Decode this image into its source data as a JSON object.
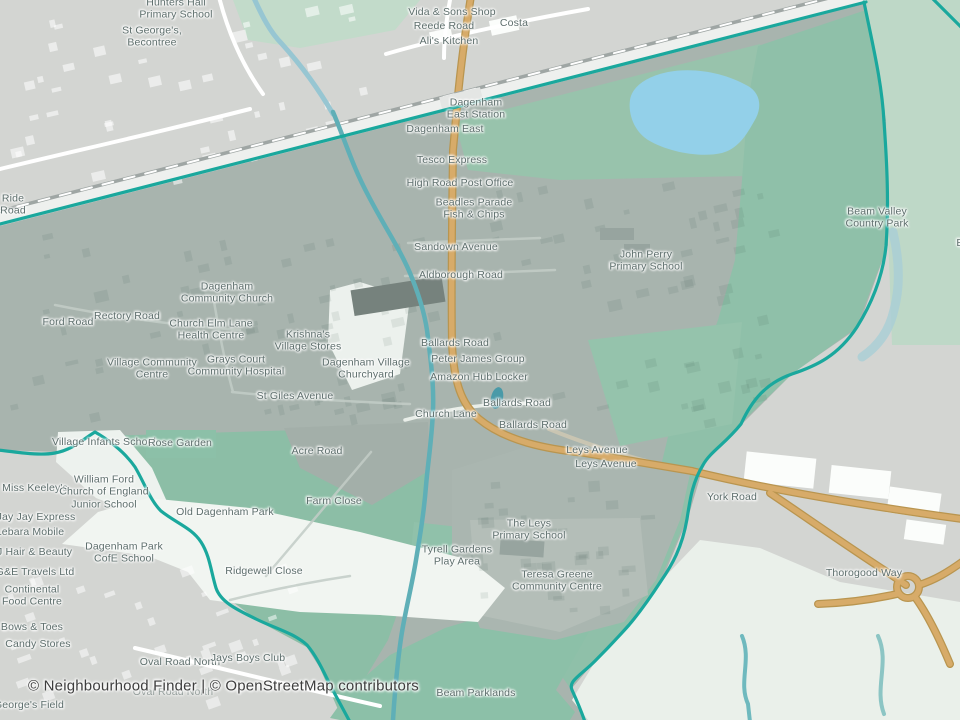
{
  "map": {
    "attribution": "© Neighbourhood Finder | © OpenStreetMap contributors",
    "colors": {
      "base_gray": "#d3d5d2",
      "inside_urban": "#a8b4ae",
      "inside_park_green": "#8fc0a8",
      "outside_park_green": "#bed8c7",
      "fields_pale": "#eaf0ea",
      "lake_blue": "#93d0e9",
      "river_teal": "#5fafb7",
      "boundary_teal": "#1aa89d",
      "road_orange": "#d2a763",
      "road_white": "#ffffff",
      "label_gray": "#5d6e6c"
    },
    "labels": [
      {
        "t": "Hunters Hall\nPrimary School",
        "x": 176,
        "y": 9
      },
      {
        "t": "St George's,\nBecontree",
        "x": 152,
        "y": 37
      },
      {
        "t": "Vida & Sons Shop",
        "x": 452,
        "y": 12
      },
      {
        "t": "Reede Road",
        "x": 444,
        "y": 26
      },
      {
        "t": "Ali's Kitchen",
        "x": 449,
        "y": 41
      },
      {
        "t": "Costa",
        "x": 514,
        "y": 23
      },
      {
        "t": "Ride\nRoad",
        "x": 13,
        "y": 205
      },
      {
        "t": "Dagenham\nEast Station",
        "x": 476,
        "y": 109
      },
      {
        "t": "Dagenham East",
        "x": 445,
        "y": 129
      },
      {
        "t": "Tesco Express",
        "x": 452,
        "y": 160
      },
      {
        "t": "High Road Post Office",
        "x": 460,
        "y": 183
      },
      {
        "t": "Beadles Parade\nFish & Chips",
        "x": 474,
        "y": 209
      },
      {
        "t": "Sandown Avenue",
        "x": 456,
        "y": 247
      },
      {
        "t": "Aldborough Road",
        "x": 461,
        "y": 275
      },
      {
        "t": "John Perry\nPrimary School",
        "x": 646,
        "y": 261
      },
      {
        "t": "Beam Valley\nCountry Park",
        "x": 877,
        "y": 218
      },
      {
        "t": "Bretons",
        "x": 975,
        "y": 243
      },
      {
        "t": "Ford Road",
        "x": 68,
        "y": 322
      },
      {
        "t": "Rectory Road",
        "x": 127,
        "y": 316
      },
      {
        "t": "Dagenham\nCommunity Church",
        "x": 227,
        "y": 293
      },
      {
        "t": "Church Elm Lane\nHealth Centre",
        "x": 211,
        "y": 330
      },
      {
        "t": "Krishna's\nVillage Stores",
        "x": 308,
        "y": 341
      },
      {
        "t": "Village Community\nCentre",
        "x": 152,
        "y": 369
      },
      {
        "t": "Grays Court\nCommunity Hospital",
        "x": 236,
        "y": 366
      },
      {
        "t": "Dagenham Village\nChurchyard",
        "x": 366,
        "y": 369
      },
      {
        "t": "Ballards Road",
        "x": 455,
        "y": 343
      },
      {
        "t": "Peter James Group",
        "x": 478,
        "y": 359
      },
      {
        "t": "Amazon Hub Locker",
        "x": 479,
        "y": 377
      },
      {
        "t": "St Giles Avenue",
        "x": 295,
        "y": 396
      },
      {
        "t": "Church Lane",
        "x": 446,
        "y": 414
      },
      {
        "t": "Ballards Road",
        "x": 517,
        "y": 403
      },
      {
        "t": "Ballards Road",
        "x": 533,
        "y": 425
      },
      {
        "t": "Leys Avenue",
        "x": 597,
        "y": 450
      },
      {
        "t": "Leys Avenue",
        "x": 606,
        "y": 464
      },
      {
        "t": "York Road",
        "x": 732,
        "y": 497
      },
      {
        "t": "Village Infants School",
        "x": 104,
        "y": 442
      },
      {
        "t": "Rose Garden",
        "x": 180,
        "y": 443
      },
      {
        "t": "Miss Keeley's",
        "x": 35,
        "y": 488
      },
      {
        "t": "William Ford\nChurch of England\nJunior School",
        "x": 104,
        "y": 492
      },
      {
        "t": "Jay Jay Express",
        "x": 36,
        "y": 517
      },
      {
        "t": "Lebara Mobile",
        "x": 30,
        "y": 532
      },
      {
        "t": "&J Hair & Beauty",
        "x": 31,
        "y": 552
      },
      {
        "t": "G&E Travels Ltd",
        "x": 35,
        "y": 572
      },
      {
        "t": "Continental\nFood Centre",
        "x": 32,
        "y": 596
      },
      {
        "t": "Bows & Toes",
        "x": 32,
        "y": 627
      },
      {
        "t": "Candy Stores",
        "x": 38,
        "y": 644
      },
      {
        "t": "Dagenham Park\nCofE School",
        "x": 124,
        "y": 553
      },
      {
        "t": "Old Dagenham Park",
        "x": 225,
        "y": 512
      },
      {
        "t": "Acre Road",
        "x": 317,
        "y": 451
      },
      {
        "t": "Farm Close",
        "x": 334,
        "y": 501
      },
      {
        "t": "Ridgewell Close",
        "x": 264,
        "y": 571
      },
      {
        "t": "The Leys\nPrimary School",
        "x": 529,
        "y": 530
      },
      {
        "t": "Tyrell Gardens\nPlay Area",
        "x": 457,
        "y": 556
      },
      {
        "t": "Teresa Greene\nCommunity Centre",
        "x": 557,
        "y": 581
      },
      {
        "t": "Thorogood Way",
        "x": 864,
        "y": 573
      },
      {
        "t": "Oval Road North",
        "x": 180,
        "y": 662
      },
      {
        "t": "Jays Boys Club",
        "x": 248,
        "y": 658
      },
      {
        "t": "Oval Road North",
        "x": 173,
        "y": 692,
        "c": "faint"
      },
      {
        "t": "Beam Parklands",
        "x": 476,
        "y": 693
      },
      {
        "t": "George's Field",
        "x": 29,
        "y": 705
      }
    ]
  }
}
